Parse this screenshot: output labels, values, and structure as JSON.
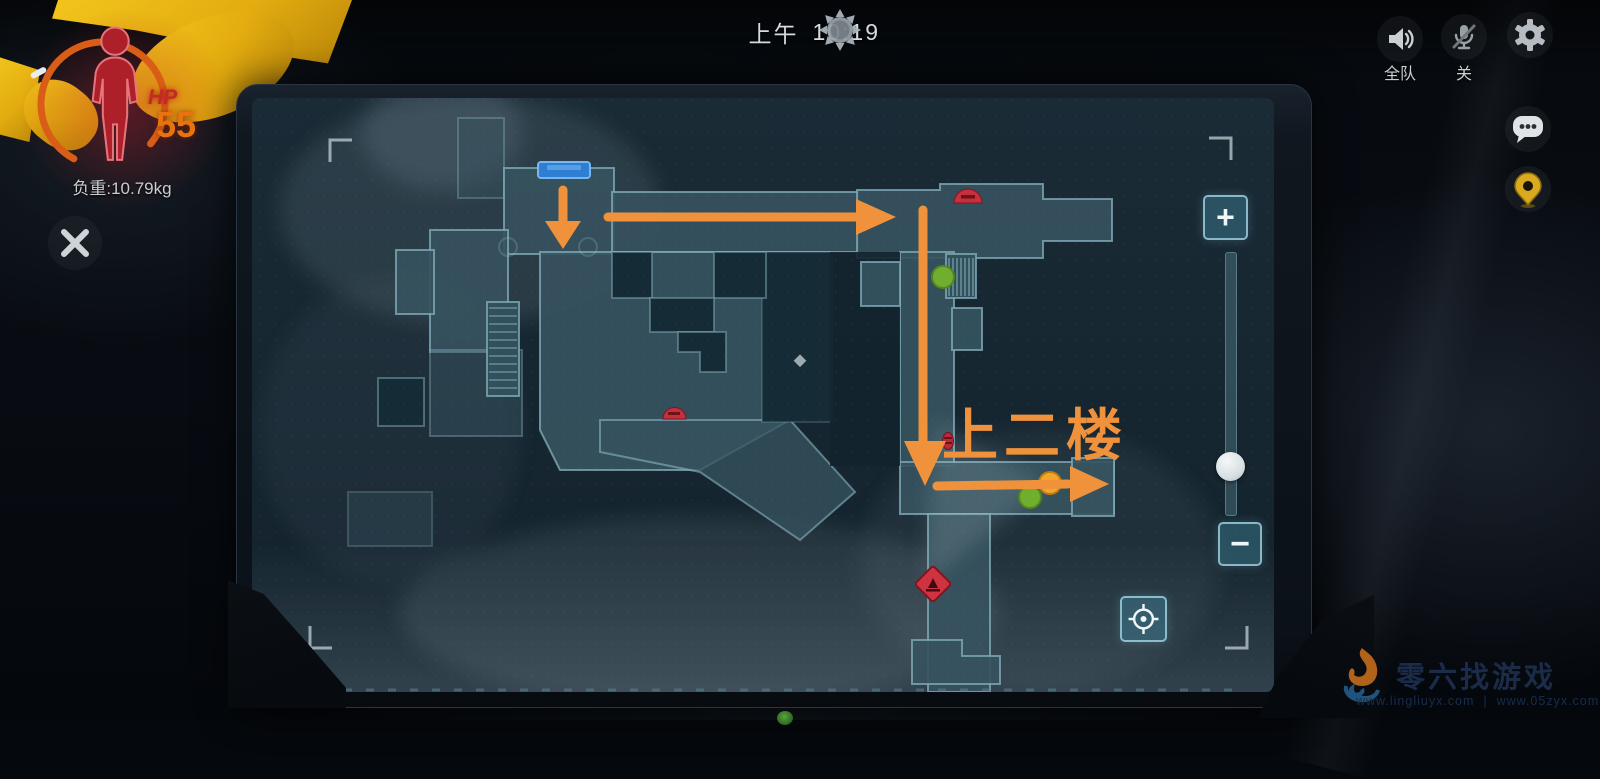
{
  "screen": {
    "time": {
      "period": "上午",
      "clock": "10:19",
      "icon": "sun-icon"
    },
    "health": {
      "label": "HP",
      "value": "55",
      "weight": "负重:10.79kg"
    },
    "voice": {
      "speaker_label": "全队",
      "mic_label": "关"
    }
  },
  "map": {
    "annotation": "上二楼",
    "zoom_in": "+",
    "zoom_out": "−",
    "markers": [
      {
        "name": "door-marker",
        "type": "blue-door",
        "x": 563,
        "y": 170
      },
      {
        "name": "stairs-upper",
        "type": "stairs",
        "x": 960,
        "y": 276
      },
      {
        "name": "stairs-left",
        "type": "stairs",
        "x": 503,
        "y": 349
      },
      {
        "name": "teammate-dot",
        "type": "green",
        "x": 943,
        "y": 277
      },
      {
        "name": "teammate-dot",
        "type": "green",
        "x": 1030,
        "y": 497
      },
      {
        "name": "player-dot",
        "type": "orange",
        "x": 1050,
        "y": 483
      },
      {
        "name": "poi",
        "type": "red-dome",
        "x": 968,
        "y": 197
      },
      {
        "name": "poi",
        "type": "red-dome",
        "x": 674,
        "y": 413
      },
      {
        "name": "poi",
        "type": "red-oval",
        "x": 948,
        "y": 441
      },
      {
        "name": "hazard",
        "type": "red-diamond",
        "x": 933,
        "y": 584
      }
    ],
    "route": [
      {
        "step": 1,
        "type": "arrow-down",
        "from": [
          563,
          190
        ],
        "to": [
          563,
          248
        ]
      },
      {
        "step": 2,
        "type": "arrow-right",
        "from": [
          608,
          217
        ],
        "to": [
          896,
          217
        ]
      },
      {
        "step": 3,
        "type": "arrow-down",
        "from": [
          923,
          210
        ],
        "to": [
          925,
          486
        ]
      },
      {
        "step": 4,
        "type": "arrow-right",
        "from": [
          937,
          486
        ],
        "to": [
          1109,
          484
        ]
      }
    ]
  },
  "watermark": {
    "name": "零六找游戏",
    "url_left": "www.lingliuyx.com",
    "url_right": "www.05zyx.com"
  },
  "colors": {
    "route_orange": "#F0923C",
    "hp_red": "#C62828",
    "hp_value_orange": "#E8730F",
    "map_wall": "#7FA9B6",
    "map_floor": "#36525E",
    "marker_green": "#6FAE2F",
    "marker_orange": "#F4A62A",
    "door_blue": "#2E7ED4",
    "icon_red": "#C62F3C",
    "pin_gold": "#D9A91E"
  }
}
